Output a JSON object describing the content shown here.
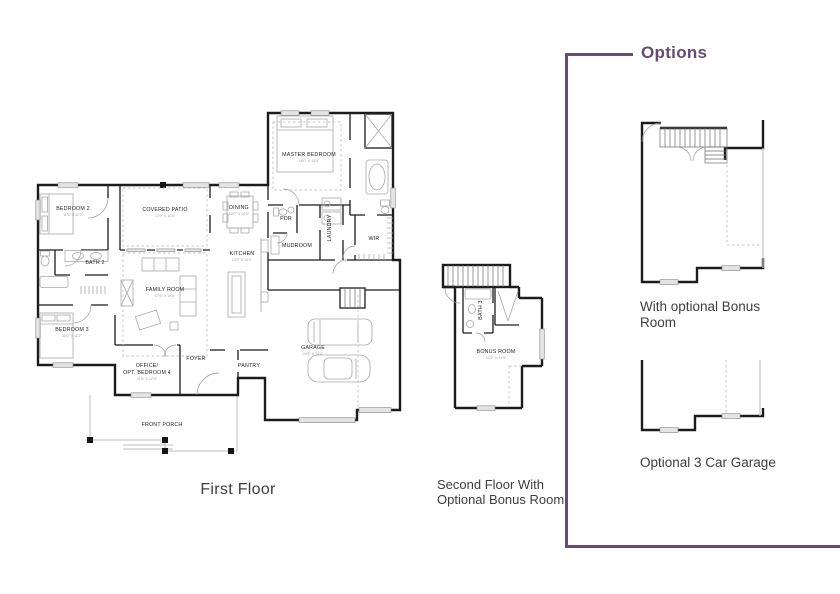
{
  "accent_color": "#6a4a72",
  "captions": {
    "first_floor": "First Floor",
    "second_floor_line1": "Second Floor With",
    "second_floor_line2": "Optional Bonus Room",
    "options_title": "Options",
    "option1_line1": "With optional Bonus",
    "option1_line2": "Room",
    "option2": "Optional 3 Car Garage"
  },
  "first_floor_rooms": {
    "bedroom2": "BEDROOM 2",
    "bedroom2_dim": "11'5\" X 11'0\"",
    "covered_patio": "COVERED PATIO",
    "covered_patio_dim": "17'9\" X 10'0\"",
    "dining": "DINING",
    "dining_dim": "10'0\" X 12'0\"",
    "kitchen": "KITCHEN",
    "kitchen_dim": "13'0\" X 10'1\"",
    "master_bedroom": "MASTER BEDROOM",
    "master_bedroom_dim": "16'0\" X 14'4\"",
    "pdr": "PDR",
    "mudroom": "MUDROOM",
    "laundry": "LAUNDRY",
    "wir": "WIR",
    "bath2": "BATH 2",
    "family_room": "FAMILY ROOM",
    "family_room_dim": "17'5\" X 19'8\"",
    "bedroom3": "BEDROOM 3",
    "bedroom3_dim": "11'0\" X 11'2\"",
    "office_line1": "OFFICE/",
    "office_line2": "OPT. BEDROOM 4",
    "office_dim": "11'6\" X 12'0\"",
    "foyer": "FOYER",
    "pantry": "PANTRY",
    "garage": "GARAGE",
    "garage_dim": "24'6\" X 24'4\"",
    "front_porch": "FRONT PORCH"
  },
  "second_floor_rooms": {
    "bonus_room": "BONUS ROOM",
    "bonus_room_dim": "13'9\" X 14'9\"",
    "bath3": "BATH 3"
  }
}
